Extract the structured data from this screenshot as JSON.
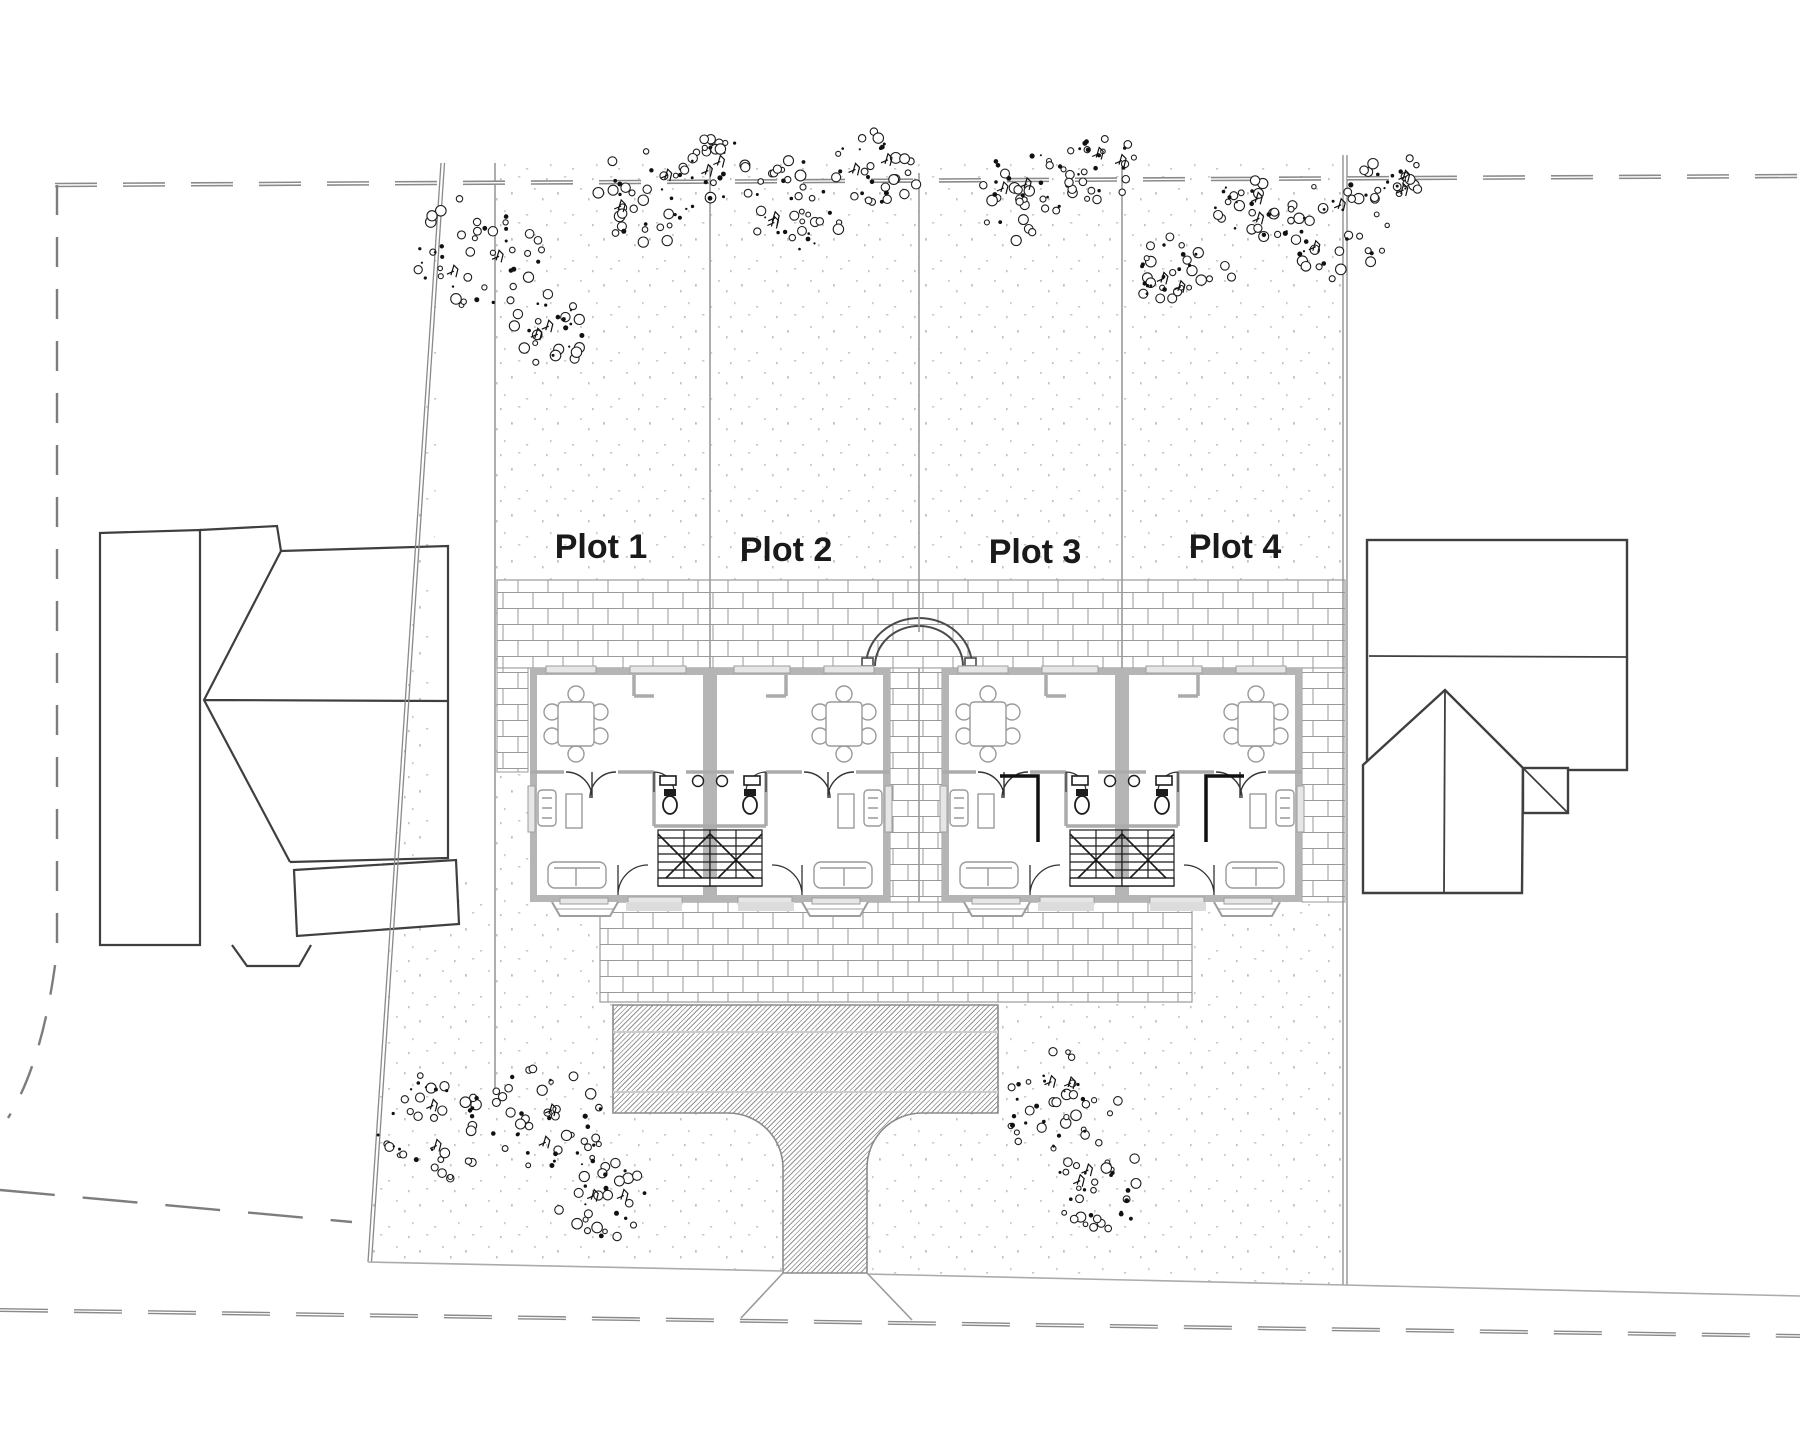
{
  "title": "Site plan - proposed development of four plots",
  "plots": [
    {
      "label": "Plot 1",
      "x": 601,
      "y": 558
    },
    {
      "label": "Plot 2",
      "x": 786,
      "y": 561
    },
    {
      "label": "Plot 3",
      "x": 1035,
      "y": 563
    },
    {
      "label": "Plot 4",
      "x": 1235,
      "y": 558
    }
  ],
  "trees": {
    "top_row": [
      {
        "x": 480,
        "y": 255,
        "r": 68
      },
      {
        "x": 548,
        "y": 330,
        "r": 46
      },
      {
        "x": 645,
        "y": 198,
        "r": 56
      },
      {
        "x": 722,
        "y": 168,
        "r": 40
      },
      {
        "x": 795,
        "y": 205,
        "r": 54
      },
      {
        "x": 876,
        "y": 170,
        "r": 47
      },
      {
        "x": 1023,
        "y": 195,
        "r": 56
      },
      {
        "x": 1100,
        "y": 166,
        "r": 40
      },
      {
        "x": 1185,
        "y": 275,
        "r": 52
      },
      {
        "x": 1252,
        "y": 205,
        "r": 44
      },
      {
        "x": 1333,
        "y": 228,
        "r": 58
      },
      {
        "x": 1392,
        "y": 182,
        "r": 34
      }
    ],
    "bottom_clusters": [
      {
        "x": 432,
        "y": 1128,
        "r": 62
      },
      {
        "x": 545,
        "y": 1122,
        "r": 66
      },
      {
        "x": 602,
        "y": 1198,
        "r": 48
      },
      {
        "x": 1060,
        "y": 1105,
        "r": 62
      },
      {
        "x": 1100,
        "y": 1190,
        "r": 52
      }
    ]
  },
  "colors": {
    "ink": "#3f3f3f",
    "boundary": "#8a8a8a",
    "wall": "#b5b5b5",
    "brick_line": "#9a9a9a",
    "drive_hatch": "#5f5f5f",
    "stipple": "#c2c2c2",
    "label": "#1a1a1a",
    "dark_fixture": "#1c1c1c"
  },
  "paving": {
    "drive_joint_lines_y": [
      1032,
      1092
    ]
  }
}
